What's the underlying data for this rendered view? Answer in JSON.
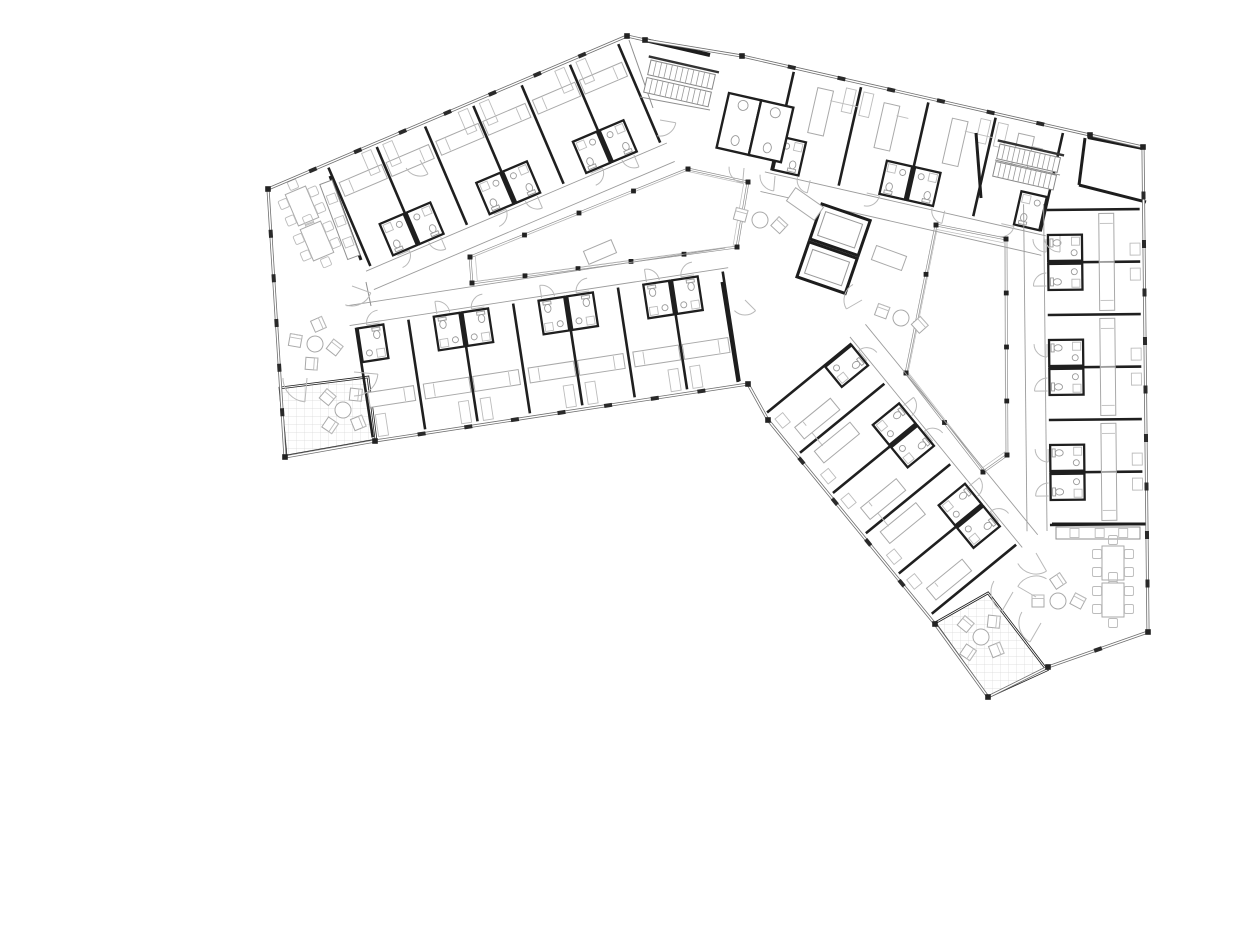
{
  "meta": {
    "type": "architectural-floor-plan",
    "subject": "angular-residence-hall-typical-floor",
    "canvas": {
      "width": 1250,
      "height": 944
    }
  },
  "colors": {
    "background": "#ffffff",
    "wall_dark": "#1d1d1d",
    "wall_mid": "#555555",
    "glass_wall": "#6e6e6e",
    "corridor_line": "#9c9c9c",
    "furniture": "#a9a9a9",
    "door_arc": "#b9b9b9",
    "grid": "#d8d8d8",
    "post": "#222222"
  },
  "plan": {
    "exterior": {
      "points": [
        [
          268,
          189
        ],
        [
          627,
          36
        ],
        [
          645,
          40
        ],
        [
          742,
          56
        ],
        [
          1090,
          135
        ],
        [
          1143,
          147
        ],
        [
          1148,
          632
        ],
        [
          1048,
          667
        ],
        [
          988,
          697
        ],
        [
          935,
          624
        ],
        [
          768,
          420
        ],
        [
          748,
          384
        ],
        [
          375,
          441
        ],
        [
          285,
          457
        ]
      ],
      "tick_edges": [
        0,
        3,
        5,
        6,
        9,
        11,
        13
      ],
      "tick_spacing": 48
    },
    "canopy_walls": [
      [
        [
          645,
          40
        ],
        [
          710,
          55
        ]
      ],
      [
        [
          1088,
          137
        ],
        [
          1143,
          148
        ]
      ]
    ],
    "thick_walls": [
      [
        [
          330,
          176
        ],
        [
          361,
          260
        ]
      ],
      [
        [
          722,
          282
        ],
        [
          738,
          382
        ]
      ],
      [
        [
          1052,
          524
        ],
        [
          1148,
          524
        ]
      ],
      [
        [
          1085,
          138
        ],
        [
          1079,
          185
        ]
      ],
      [
        [
          1079,
          185
        ],
        [
          1146,
          202
        ]
      ],
      [
        [
          976,
          133
        ],
        [
          981,
          198
        ]
      ]
    ],
    "thin_walls": [
      [
        [
          629,
          40
        ],
        [
          653,
          108
        ]
      ],
      [
        [
          640,
          97
        ],
        [
          710,
          110
        ]
      ],
      [
        [
          995,
          160
        ],
        [
          1060,
          175
        ]
      ],
      [
        [
          366,
          282
        ],
        [
          371,
          306
        ]
      ]
    ],
    "courtyards": [
      {
        "name": "courtyard-west",
        "points": [
          [
            470,
            257
          ],
          [
            688,
            169
          ],
          [
            748,
            182
          ],
          [
            737,
            247
          ],
          [
            472,
            283
          ]
        ],
        "post_spacing": 56
      },
      {
        "name": "courtyard-east",
        "points": [
          [
            936,
            225
          ],
          [
            1006,
            239
          ],
          [
            1007,
            455
          ],
          [
            983,
            472
          ],
          [
            906,
            373
          ]
        ],
        "post_spacing": 56
      }
    ],
    "terraces": [
      {
        "name": "terrace-southwest",
        "points": [
          [
            280,
            388
          ],
          [
            368,
            377
          ],
          [
            376,
            440
          ],
          [
            286,
            456
          ]
        ]
      },
      {
        "name": "terrace-southeast",
        "points": [
          [
            935,
            623
          ],
          [
            988,
            593
          ],
          [
            1047,
            670
          ],
          [
            988,
            697
          ]
        ]
      }
    ],
    "wings": [
      {
        "name": "wing-north-upper-rooms",
        "origin": [
          268,
          189
        ],
        "angle": -23.07,
        "start": 64,
        "pitch": 52.5,
        "count": 6,
        "depth": 112,
        "phase": 0,
        "bed": [
          4,
          22,
          46,
          15
        ],
        "desk": [
          36,
          4,
          10,
          24
        ]
      },
      {
        "name": "wing-north-lower-rooms",
        "origin": [
          748,
          384
        ],
        "angle": 171.3,
        "start": 8,
        "pitch": 53,
        "count": 7,
        "depth": 116,
        "phase": 0,
        "bed": [
          5,
          34,
          46,
          15
        ],
        "desk": [
          37,
          4,
          10,
          22
        ]
      },
      {
        "name": "wing-top-rooms",
        "origin": [
          742,
          56
        ],
        "angle": 12.8,
        "start": 54,
        "pitch": 69,
        "count": 4,
        "depth": 106,
        "phase": 1,
        "bed": [
          26,
          14,
          16,
          46
        ],
        "desk": [
          4,
          8,
          10,
          24
        ]
      },
      {
        "name": "wing-east-rooms",
        "origin": [
          1143,
          147
        ],
        "angle": 89.4,
        "start": 62,
        "pitch": 52.5,
        "count": 6,
        "depth": 98,
        "phase": 0,
        "bed": [
          4,
          30,
          48,
          15
        ],
        "desk": [
          34,
          4,
          12,
          10
        ]
      },
      {
        "name": "wing-diagonal-rooms",
        "origin": [
          935,
          624
        ],
        "angle": 230.7,
        "start": 10,
        "pitch": 52,
        "count": 5,
        "depth": 114,
        "phase": 0,
        "bed": [
          8,
          16,
          15,
          46
        ],
        "desk": [
          30,
          6,
          12,
          10
        ]
      }
    ],
    "stairs": [
      {
        "name": "stair-main-entrance",
        "x": 651,
        "y": 60,
        "rot": 12.8,
        "len": 66,
        "w": 15,
        "flights": 2,
        "treads": 12
      },
      {
        "name": "stair-northeast",
        "x": 1000,
        "y": 144,
        "rot": 12.8,
        "len": 62,
        "w": 15,
        "flights": 2,
        "treads": 12
      }
    ],
    "wc_block": {
      "origin": [
        729,
        93
      ],
      "rot": 12.8,
      "cells": 2,
      "cell_w": 33,
      "cell_h": 56
    },
    "elevator_block": {
      "origin": [
        822,
        204
      ],
      "rot": 19,
      "cells": 2,
      "cell_w": 51,
      "cell_h": 37
    },
    "counters": [
      {
        "name": "kitchenette-west",
        "x": 332,
        "y": 180,
        "rot": 69.6,
        "len": 80,
        "w": 13
      },
      {
        "name": "kitchenette-southeast",
        "x": 1056,
        "y": 527,
        "rot": 0,
        "len": 84,
        "w": 12
      }
    ],
    "tables": [
      {
        "x": 302,
        "y": 206,
        "rot": -23
      },
      {
        "x": 317,
        "y": 241,
        "rot": -23
      },
      {
        "x": 1113,
        "y": 563,
        "rot": 0
      },
      {
        "x": 1113,
        "y": 600,
        "rot": 0
      }
    ],
    "lounges": [
      {
        "x": 315,
        "y": 344,
        "rot": 10,
        "chairs": 4
      },
      {
        "x": 343,
        "y": 410,
        "rot": 40,
        "chairs": 4
      },
      {
        "x": 981,
        "y": 637,
        "rot": 40,
        "chairs": 4
      },
      {
        "x": 760,
        "y": 220,
        "rot": 15,
        "chairs": 2
      },
      {
        "x": 901,
        "y": 318,
        "rot": 20,
        "chairs": 2
      },
      {
        "x": 1058,
        "y": 601,
        "rot": 0,
        "chairs": 3
      }
    ],
    "benches": [
      {
        "x": 805,
        "y": 204,
        "rot": 35,
        "w": 34,
        "h": 16
      },
      {
        "x": 889,
        "y": 258,
        "rot": 20,
        "w": 32,
        "h": 15
      },
      {
        "x": 600,
        "y": 252,
        "rot": -23,
        "w": 30,
        "h": 14
      }
    ],
    "door_arcs": [
      {
        "c": [
          352,
          286
        ],
        "r": 20,
        "a0": 20,
        "a1": 110
      },
      {
        "c": [
          307,
          378
        ],
        "r": 24,
        "a0": 95,
        "a1": 180
      },
      {
        "c": [
          354,
          372
        ],
        "r": 24,
        "a0": 5,
        "a1": 90
      },
      {
        "c": [
          1013,
          592
        ],
        "r": 22,
        "a0": 120,
        "a1": 210
      },
      {
        "c": [
          1041,
          623
        ],
        "r": 22,
        "a0": 120,
        "a1": 210
      },
      {
        "c": [
          1036,
          553
        ],
        "r": 21,
        "a0": 60,
        "a1": 150
      },
      {
        "c": [
          1036,
          597
        ],
        "r": 21,
        "a0": 210,
        "a1": 300
      },
      {
        "c": [
          744,
          168
        ],
        "r": 15,
        "a0": 95,
        "a1": 185
      },
      {
        "c": [
          775,
          176
        ],
        "r": 15,
        "a0": 95,
        "a1": 185
      },
      {
        "c": [
          862,
          300
        ],
        "r": 18,
        "a0": 150,
        "a1": 240
      },
      {
        "c": [
          660,
          120
        ],
        "r": 16,
        "a0": 10,
        "a1": 100
      },
      {
        "c": [
          745,
          300
        ],
        "r": 15,
        "a0": 45,
        "a1": 135
      },
      {
        "c": [
          1060,
          236
        ],
        "r": 16,
        "a0": 90,
        "a1": 180
      },
      {
        "c": [
          420,
          160
        ],
        "r": 16,
        "a0": 60,
        "a1": 150
      }
    ]
  }
}
